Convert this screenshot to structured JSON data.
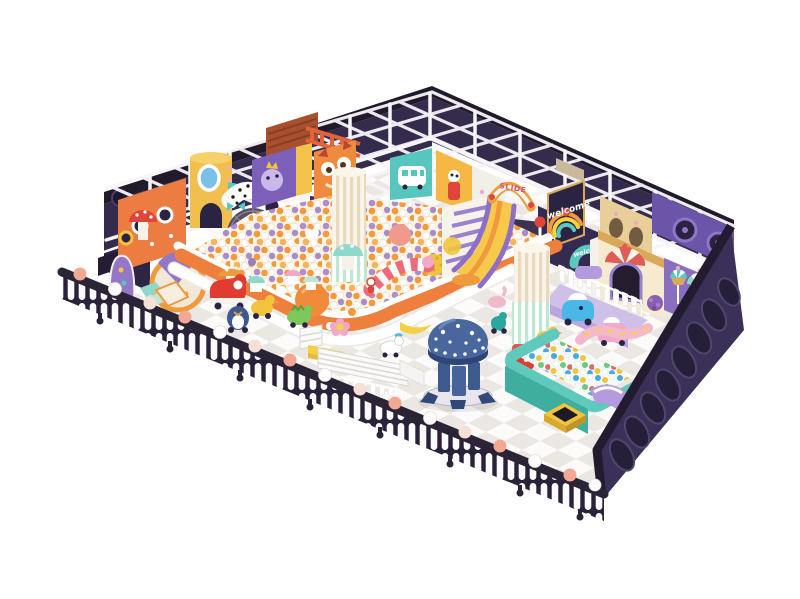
{
  "image": {
    "type": "3d-render",
    "subject": "children indoor playground soft play structure with ball pits",
    "view": "isometric aerial",
    "background": "#ffffff"
  },
  "signs": {
    "slide_sign": "SLIDE",
    "welcome_rainbow_sign": "welcome",
    "welcome_arch_sign": "welcome"
  },
  "palette": {
    "page_bg": "#ffffff",
    "wall_trim": "#211a2b",
    "wall_navy": "#342b4d",
    "wall_face": "#3b3158",
    "oval_dark": "#261f3a",
    "frame_white": "#f7f5f8",
    "floor": "#fcfbf9",
    "floor_tile": "#e9e6e1",
    "fence_navy": "#2a2238",
    "picket_white": "#fbfafc",
    "ornament_salmon": "#f2a894",
    "pit_orange": "#ee7f3d",
    "ball_orange": "#f59a3c",
    "ball_purple": "#a98cc7",
    "pool_teal": "#5fc9bc",
    "pool_face": "#3fae9f",
    "octopus_blue": "#49679c",
    "octopus_rim": "#2e4577",
    "slide_yellow": "#f8c84a",
    "slide_orange": "#f09a3e",
    "slide_purple": "#8d6fc8",
    "arch_gold": "#e8a23f",
    "slide_text_pink": "#e0527a",
    "castle_cream": "#f6ead0",
    "castle_gold": "#d9a959",
    "awning_red": "#e05c55",
    "panel_purple": "#7b5fb8",
    "panel_orange": "#ec7c42",
    "panel_teal": "#58c6bf",
    "panel_yellow": "#f0bf4e",
    "owl_orange": "#ee8b3f",
    "mint": "#8fd8cc",
    "lavender": "#cfc0ea",
    "toy_red": "#e03c30",
    "toy_blue": "#49b8e8",
    "toy_pink": "#f2a8c8",
    "toy_green": "#7cc85c",
    "toy_yellow": "#f2c43d",
    "bench_yellow": "#f5d03f",
    "rust": "#a8502e",
    "ladder_orange": "#e2633a",
    "welcome_navy": "#2b2342",
    "rainbow_orange": "#f59a3c",
    "rainbow_yellow": "#f5d43f",
    "rainbow_teal": "#5bc8c0"
  },
  "items": [
    "white steel frame grid roof",
    "dark navy perimeter walls with porthole ovals",
    "main ball pit with orange scalloped border and white pickets",
    "rainbow slide with SLIDE arch sign and rainbow stairs",
    "welcome rainbow sign panel",
    "teal welcome arch sign",
    "striped candy columns",
    "octopus carousel with white dots",
    "teal toddler ball pool with purple slides",
    "candy castle with striped awning and cupcake balloons",
    "orange play panel with portholes",
    "yellow cylinder tower",
    "polka dot crawl tunnel",
    "spider web climber",
    "purple monster panel",
    "owl face panel",
    "teal bus panel",
    "mushroom tables and cupcake stools",
    "ride-on toys: red car, ducks, penguin, dino, scooters",
    "white picket perimeter fence with ball ornaments and casters",
    "shoe racks, yellow bench and safety gate",
    "checkered white-grey floor"
  ]
}
